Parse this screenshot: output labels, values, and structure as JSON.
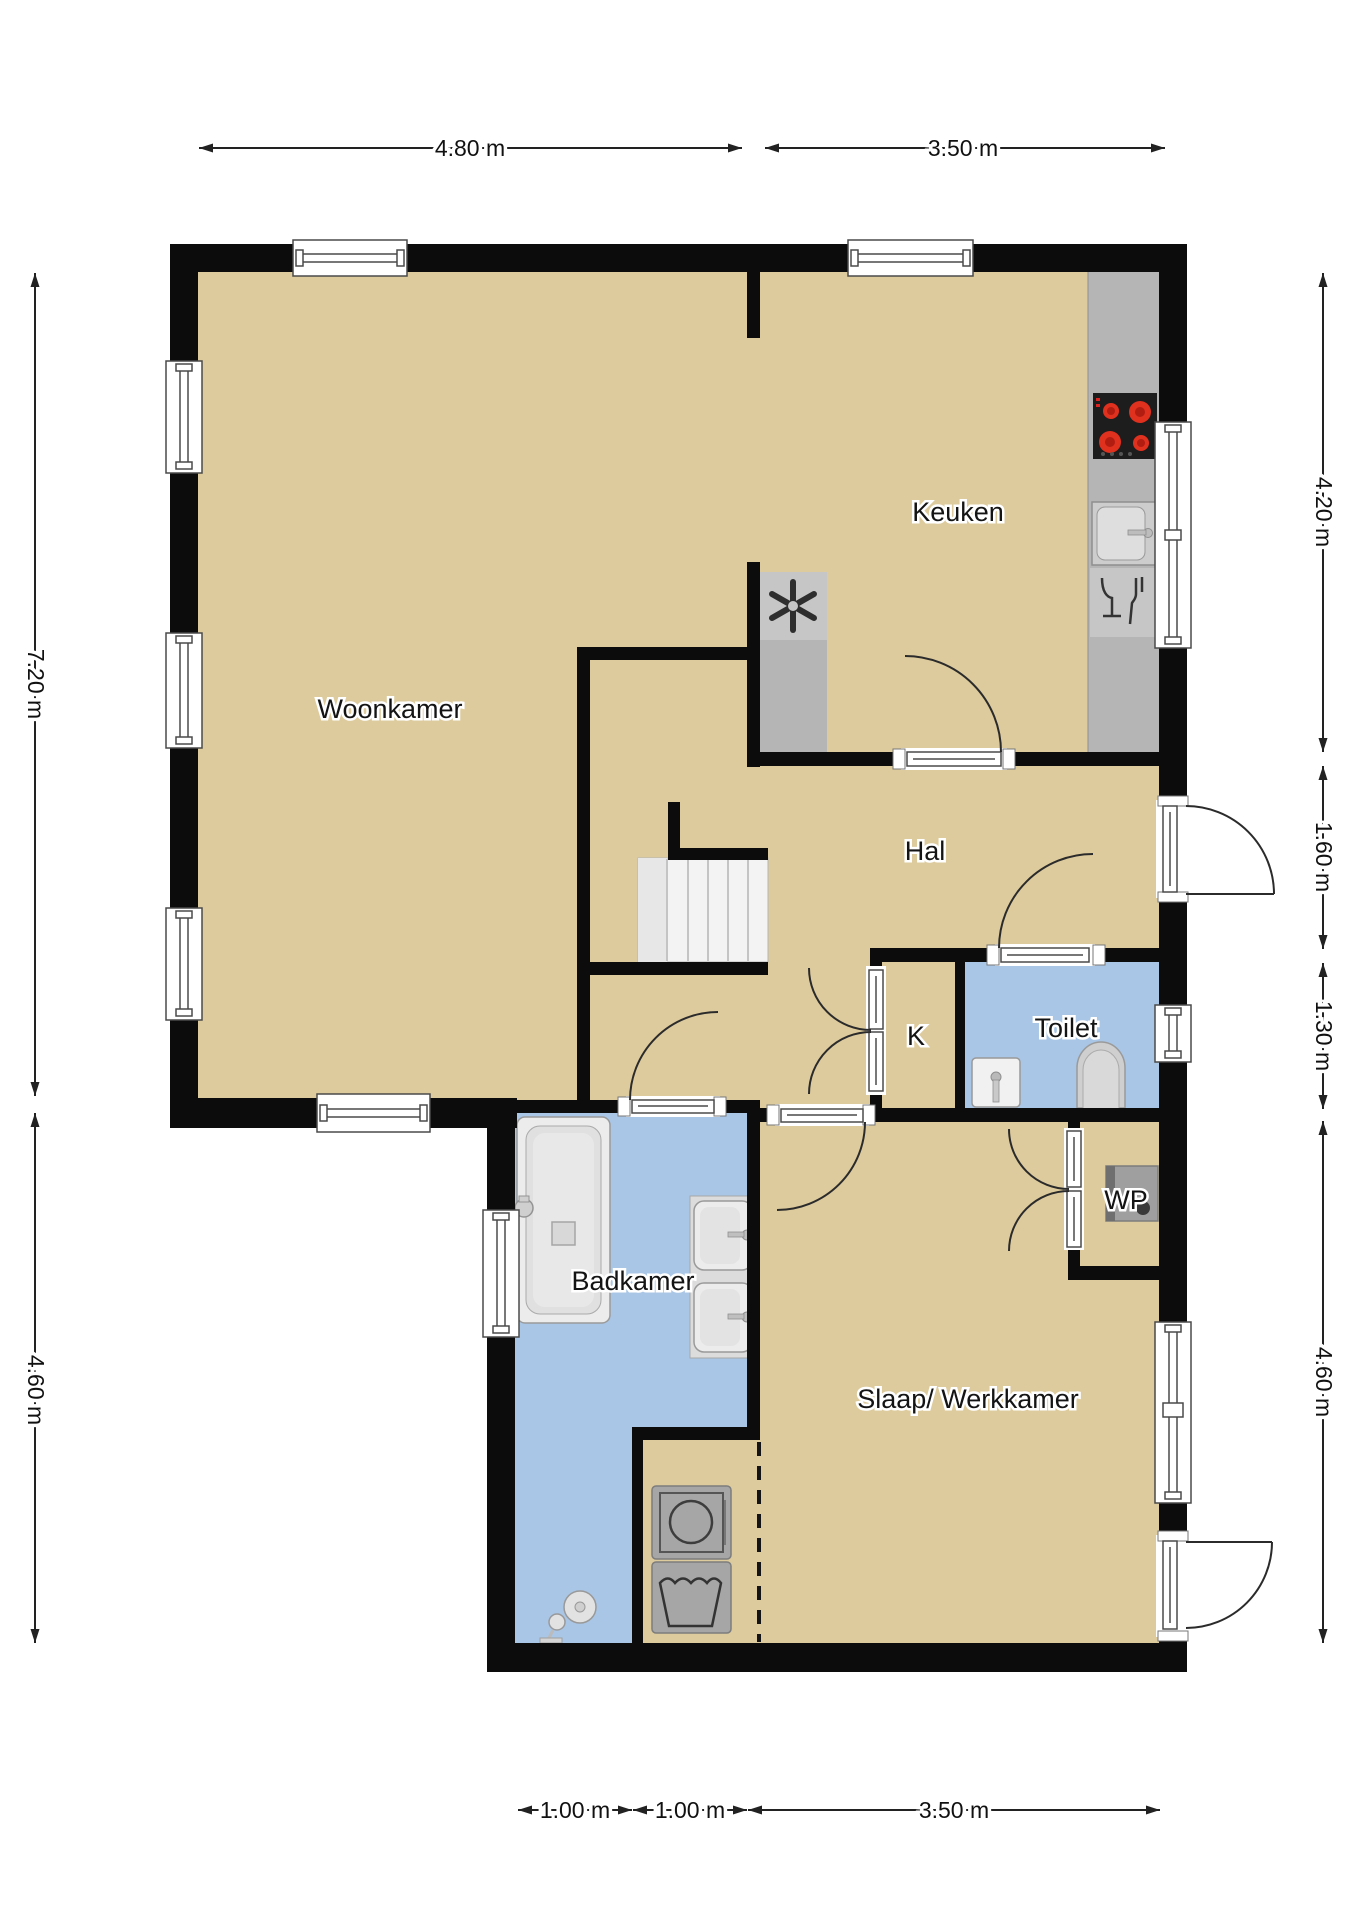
{
  "rooms": {
    "woonkamer": "Woonkamer",
    "keuken": "Keuken",
    "hal": "Hal",
    "k": "K",
    "toilet": "Toilet",
    "badkamer": "Badkamer",
    "slaap": "Slaap/ Werkkamer",
    "wp": "WP"
  },
  "dimensions": {
    "top": [
      "4.80 m",
      "3.50 m"
    ],
    "right": [
      "4.20 m",
      "1.60 m",
      "1.30 m",
      "4.60 m"
    ],
    "left": [
      "7.20 m",
      "4.60 m"
    ],
    "bottom": [
      "1.00 m",
      "1.00 m",
      "3.50 m"
    ]
  },
  "colors": {
    "floor": "#ddcb9d",
    "wet_floor": "#a9c6e6",
    "wall": "#0c0c0c",
    "counter": "#b5b5b5",
    "counter_light": "#c6c6c6",
    "stairs": "#f3f3f3",
    "burner_red": "#e0301e",
    "cooktop_black": "#1d1d1d",
    "appliance_gray": "#a6a6a6"
  }
}
